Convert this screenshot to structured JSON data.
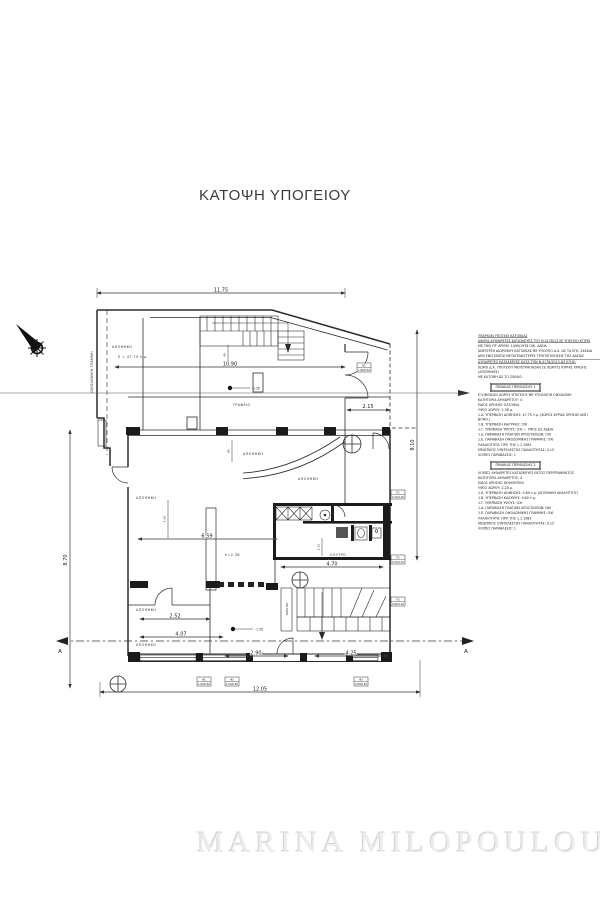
{
  "page": {
    "title": "ΚΑΤΟΨΗ ΥΠΟΓΕΙΟΥ",
    "watermark": "MARINA MILOPOULOU"
  },
  "colors": {
    "line": "#2b2b2b",
    "dim": "#333333",
    "watermark": "#ededed"
  },
  "plan": {
    "boundary_label": "ΟΙΚΟΔΟΜΙΚΗ ΓΡΑΜΜΗ",
    "rooms": {
      "storage_top": "ΑΠΟΘΗΚΗ",
      "storage_top_area": "E = 47.75 τ.μ.",
      "office": "ΓΡΑΦΕΙΟ",
      "storage_mid": "ΑΠΟΘΗΚΗ",
      "storage_right": "ΑΠΟΘΗΚΗ",
      "storage_left": "ΑΠΟΘΗΚΗ",
      "bath": "ΛΟΥΤΡΟ",
      "storage_bottom1": "ΑΠΟΘΗΚΗ",
      "storage_bottom2": "ΑΠΟΘΗΚΗ",
      "height_note": "h=2.38",
      "closet": "ΛΕΒΗΤΑΣ"
    },
    "levels": {
      "upper": "-1.35",
      "lower": "-1.35"
    },
    "dims": {
      "top": "11.75",
      "inner": "10.90",
      "entry": "2.15",
      "mid": "6.59",
      "bath": "4.70",
      "b1": "2.52",
      "b2": "4.07",
      "b3": "2.90",
      "b4": "4.25",
      "overall": "12.05",
      "left_v": "8.70",
      "right_v": "8.10",
      "v1": "40",
      "v2": "85",
      "v3": "2.50",
      "v4": "2.15"
    },
    "section": {
      "label": "A"
    },
    "tags": [
      {
        "code": "Θ1",
        "size": "1.80/2.20"
      },
      {
        "code": "Π1",
        "size": "1.00/1.20"
      },
      {
        "code": "Π2",
        "size": "1.00/1.20"
      },
      {
        "code": "Π3",
        "size": "0.80/1.20"
      },
      {
        "code": "Φ1",
        "size": "1.00/0.60"
      },
      {
        "code": "Φ2",
        "size": "1.00/0.60"
      },
      {
        "code": "Φ3",
        "size": "0.80/0.60"
      }
    ]
  },
  "notes": {
    "heading1": "ΥΠΑΡΧΟΝ ΥΠΟΓΕΙΟ ΚΑΤΟΙΚΙΑΣ",
    "heading2": "ΑΦΟΡΑ ΑΥΘΑΙΡΕΤΕΣ ΚΑΤΑΣΚΕΥΕΣ ΤΟΥ Ν.4178/13 ΣΕ ΥΠΟΓΕΙΟ ΚΤΙΡΙΟ",
    "intro_lines": [
      "ΜΕ ΤΗΝ ΥΠ' ΑΡΙΘΜ. 1499/1978 ΟΙΚ. ΑΔΕΙΑ",
      "ΑΝΕΓΕΡΣΗ ΔΙΩΡΟΦΟΥ ΚΑΤΟΙΚΙΑΣ ΜΕ ΥΠΟΓΕΙΟ Δ.Χ. ΩΣ ΤΑ ΕΓΚ. ΣΧΕΔΙΑ",
      "ΔΕΝ ΥΦΙΣΤΑΝΤΑΙ ΜΕΤΑΓΕΝΕΣΤΕΡΕΣ ΤΡΟΠΟΠΟΙΗΣΕΙΣ ΤΗΣ ΑΔΕΙΑΣ",
      "ΧΩΡΟΙ Δ.Χ. ΥΠΟΓΕΙΟΥ ΜΕΤΕΤΡΑΠΗΣΑΝ ΣΕ ΧΩΡΟΥΣ ΚΥΡΙΑΣ ΧΡΗΣΗΣ (ΑΠΟΘΗΚΕΣ)",
      "ΜΕ ΚΑΤΟΨΗ ΩΣ ΤΟ ΣΧΕΔΙΟ"
    ],
    "divider_line": "ΑΥΘΑΙΡΕΤΕΣ ΚΑΤΑΣΚΕΥΕΣ ΚΑΤΑ ΤΟΝ Ν.4178/2013 ΩΣ ΕΞΗΣ:",
    "table1": {
      "title": "ΠΙΝΑΚΑΣ ΠΕΡΑΙΩΣΗΣ 1",
      "lines": [
        "ΕΞΟΜΟΙΩΣΗ ΧΩΡΟΥ ΥΠΟΓΕΙΟΥ ΜΕ ΥΠΟΛΟΙΠΗ ΟΙΚΟΔΟΜΗ",
        "ΚΑΤΗΓΟΡΙΑ ΑΥΘΑΙΡΕΤΟΥ: 4",
        "ΕΙΔΟΣ ΧΡΗΣΗΣ: ΚΑΤΟΙΚΙΑ",
        "ΥΨΟΣ ΧΩΡΟΥ: 2.38 μ.",
        "1.Α. ΥΠΕΡΒΑΣΗ ΔΟΜΗΣΗΣ: 47.75 τ.μ. (ΧΩΡΟΣ ΚΥΡΙΑΣ ΧΡΗΣΗΣ ΑΝΤΙ ΒΟΗΘ.)",
        "1.Β. ΥΠΕΡΒΑΣΗ ΚΑΛΥΨΗΣ: ΟΧΙ",
        "1.Γ. ΥΠΕΡΒΑΣΗ ΥΨΟΥΣ: ΟΧΙ — ΥΨΟΣ ΩΣ ΑΔΕΙΑ",
        "1.Δ. ΠΑΡΑΒΙΑΣΗ ΠΛΑΓΙΩΝ ΑΠΟΣΤΑΣΕΩΝ: ΟΧΙ",
        "1.Ε. ΠΑΡΑΒΙΑΣΗ ΟΙΚΟΔΟΜΙΚΗΣ ΓΡΑΜΜΗΣ: ΟΧΙ",
        "ΠΑΛΑΙΟΤΗΤΑ: ΠΡΟ ΤΗΣ 1.1.1983",
        "ΜΕΙΩΤΙΚΟΣ ΣΥΝΤΕΛΕΣΤΗΣ ΠΑΛΑΙΟΤΗΤΑΣ: 0.15",
        "ΛΟΙΠΕΣ ΠΑΡΑΒΑΣΕΙΣ: 1"
      ]
    },
    "table2": {
      "title": "ΠΙΝΑΚΑΣ ΠΕΡΑΙΩΣΗΣ 2",
      "lines": [
        "ΛΟΙΠΕΣ ΑΥΘΑΙΡΕΤΕΣ ΚΑΤΑΣΚΕΥΕΣ ΕΚΤΟΣ ΠΕΡΙΓΡΑΜΜΑΤΟΣ",
        "ΚΑΤΗΓΟΡΙΑ ΑΥΘΑΙΡΕΤΟΥ: 4",
        "ΕΙΔΟΣ ΧΡΗΣΗΣ: ΒΟΗΘΗΤΙΚΗ",
        "ΥΨΟΣ ΧΩΡΟΥ: 2.20 μ.",
        "1.Α. ΥΠΕΡΒΑΣΗ ΔΟΜΗΣΗΣ: 9.80 τ.μ. (ΑΠΟΘΗΚΗ ΑΚΑΛΥΠΤΟΥ)",
        "1.Β. ΥΠΕΡΒΑΣΗ ΚΑΛΥΨΗΣ: 9.80 τ.μ.",
        "1.Γ. ΥΠΕΡΒΑΣΗ ΥΨΟΥΣ: ΟΧΙ",
        "1.Δ. ΠΑΡΑΒΙΑΣΗ ΠΛΑΓΙΩΝ ΑΠΟΣΤΑΣΕΩΝ: ΝΑΙ",
        "1.Ε. ΠΑΡΑΒΙΑΣΗ ΟΙΚΟΔΟΜΙΚΗΣ ΓΡΑΜΜΗΣ: ΟΧΙ",
        "ΠΑΛΑΙΟΤΗΤΑ: ΠΡΟ ΤΗΣ 1.1.1983",
        "ΜΕΙΩΤΙΚΟΣ ΣΥΝΤΕΛΕΣΤΗΣ ΠΑΛΑΙΟΤΗΤΑΣ: 0.15",
        "ΛΟΙΠΕΣ ΠΑΡΑΒΑΣΕΙΣ: 1"
      ]
    }
  }
}
